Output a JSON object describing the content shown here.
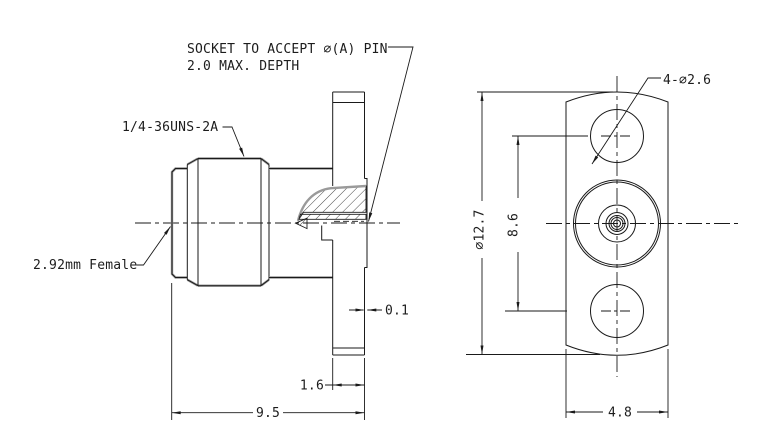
{
  "notes": {
    "socket_line1": "SOCKET TO ACCEPT ∅(A) PIN",
    "socket_line2": "2.0 MAX. DEPTH"
  },
  "labels": {
    "thread": "1/4-36UNS-2A",
    "interface": "2.92mm Female",
    "mounting_holes": "4-∅2.6"
  },
  "dimensions": {
    "overall_length": "9.5",
    "flange_thickness": "1.6",
    "boss_protrusion": "0.1",
    "flange_diameter": "∅12.7",
    "hole_spacing": "8.6",
    "flange_width": "4.8"
  },
  "colors": {
    "background": "#ffffff",
    "line": "#1a1a1a",
    "heavy_edge": "#9a9a9a"
  }
}
